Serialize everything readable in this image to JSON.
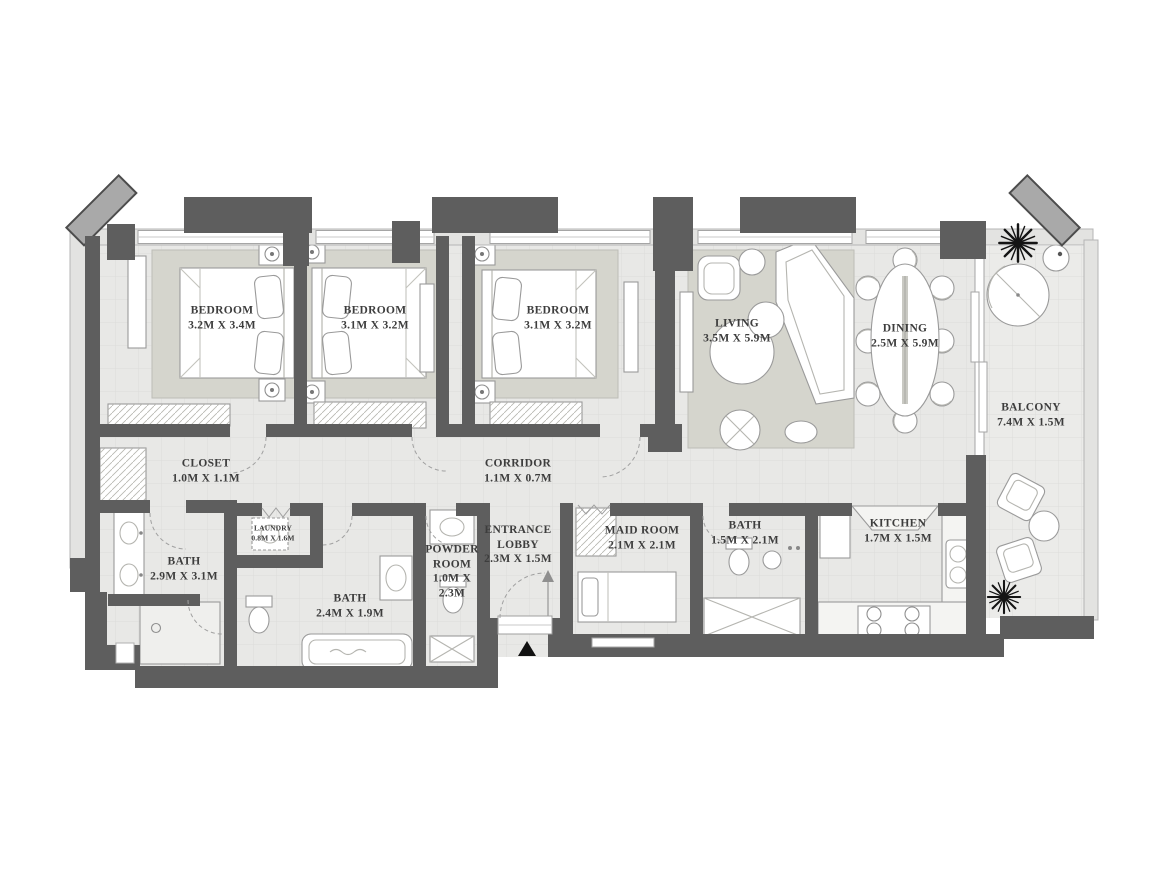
{
  "plan": {
    "rooms": [
      {
        "id": "bedroom-1",
        "name": "BEDROOM",
        "dims": "3.2M X 3.4M"
      },
      {
        "id": "bedroom-2",
        "name": "BEDROOM",
        "dims": "3.1M X 3.2M"
      },
      {
        "id": "bedroom-3",
        "name": "BEDROOM",
        "dims": "3.1M X 3.2M"
      },
      {
        "id": "living",
        "name": "LIVING",
        "dims": "3.5M X 5.9M"
      },
      {
        "id": "dining",
        "name": "DINING",
        "dims": "2.5M X 5.9M"
      },
      {
        "id": "balcony",
        "name": "BALCONY",
        "dims": "7.4M X 1.5M"
      },
      {
        "id": "closet",
        "name": "CLOSET",
        "dims": "1.0M X 1.1M"
      },
      {
        "id": "corridor",
        "name": "CORRIDOR",
        "dims": "1.1M X 0.7M"
      },
      {
        "id": "laundry",
        "name": "LAUNDRY",
        "dims": "0.8M X 1.6M"
      },
      {
        "id": "bath-master",
        "name": "BATH",
        "dims": "2.9M X 3.1M"
      },
      {
        "id": "bath-2",
        "name": "BATH",
        "dims": "2.4M X 1.9M"
      },
      {
        "id": "powder-room",
        "name": "POWDER ROOM",
        "dims": "1.0M X 2.3M"
      },
      {
        "id": "entrance-lobby",
        "name": "ENTRANCE LOBBY",
        "dims": "2.3M X 1.5M"
      },
      {
        "id": "maid-room",
        "name": "MAID ROOM",
        "dims": "2.1M X 2.1M"
      },
      {
        "id": "bath-3",
        "name": "BATH",
        "dims": "1.5M X 2.1M"
      },
      {
        "id": "kitchen",
        "name": "KITCHEN",
        "dims": "1.7M X 1.5M"
      }
    ],
    "icons": {
      "entrance_marker": "entrance-triangle-icon",
      "plant": "plant-icon"
    },
    "entrance_marker_symbol": "▲",
    "colors": {
      "wall": "#5e5e5e",
      "exterior_wall": "#e3e3e1",
      "floor": "#e8e8e6",
      "rug": "#d5d5cd",
      "furniture_fill": "#ffffff",
      "furniture_line": "#9a9a9a",
      "plant": "#141414",
      "text": "#3d3d3d"
    }
  }
}
